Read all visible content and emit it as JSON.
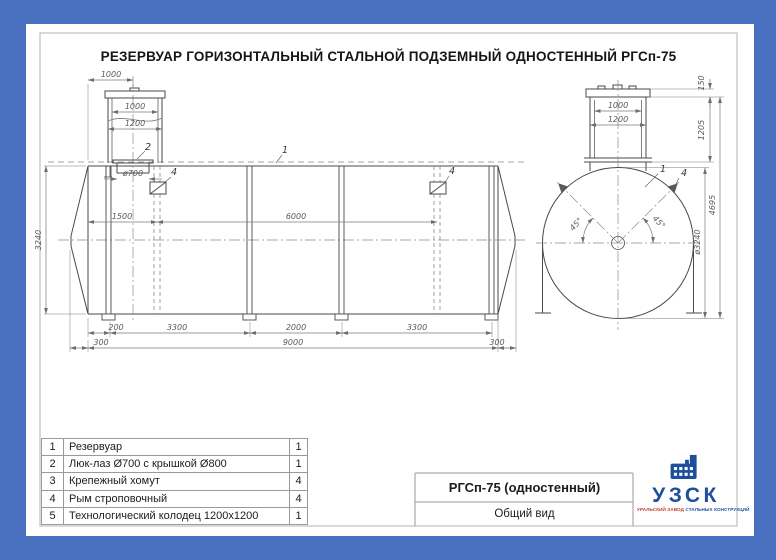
{
  "colors": {
    "border_blue": "#4a71bf",
    "logo_blue": "#1e4f9d",
    "logo_red": "#c13b2a",
    "line": "#4a4a4a",
    "dim": "#6e6e6e"
  },
  "title": "РЕЗЕРВУАР ГОРИЗОНТАЛЬНЫЙ СТАЛЬНОЙ ПОДЗЕМНЫЙ ОДНОСТЕННЫЙ РГСп-75",
  "side_view": {
    "dim_top_1000": "1000",
    "dim_well_1000": "1000",
    "dim_well_1200": "1200",
    "dim_manhole": "ø700",
    "dim_height": "3240",
    "dim_1500": "1500",
    "dim_6000": "6000",
    "dim_200": "200",
    "dim_3300a": "3300",
    "dim_2000": "2000",
    "dim_3300b": "3300",
    "dim_300a": "300",
    "dim_9000": "9000",
    "dim_300b": "300",
    "callout_tank": "1",
    "callout_manhole": "2",
    "callout_lug_left": "4",
    "callout_lug_right": "4"
  },
  "end_view": {
    "dim_150": "150",
    "dim_1000": "1000",
    "dim_1200": "1200",
    "dim_1205": "1205",
    "dim_4695": "4695",
    "dim_diameter": "ø3240",
    "angle_left": "45°",
    "angle_right": "45°",
    "callout_tank": "1",
    "callout_lug": "4"
  },
  "parts_table": {
    "rows": [
      {
        "num": "1",
        "name": "Резервуар",
        "qty": "1"
      },
      {
        "num": "2",
        "name": "Люк-лаз Ø700 с крышкой Ø800",
        "qty": "1"
      },
      {
        "num": "3",
        "name": "Крепежный хомут",
        "qty": "4"
      },
      {
        "num": "4",
        "name": "Рым строповочный",
        "qty": "4"
      },
      {
        "num": "5",
        "name": "Технологический колодец 1200x1200",
        "qty": "1"
      }
    ]
  },
  "title_block": {
    "model": "РГСп-75 (одностенный)",
    "view_name": "Общий вид",
    "logo_abbr": "УЗСК",
    "logo_tagline_1": "УРАЛЬСКИЙ ЗАВОД",
    "logo_tagline_2": "СТАЛЬНЫХ КОНСТРУКЦИЙ"
  }
}
